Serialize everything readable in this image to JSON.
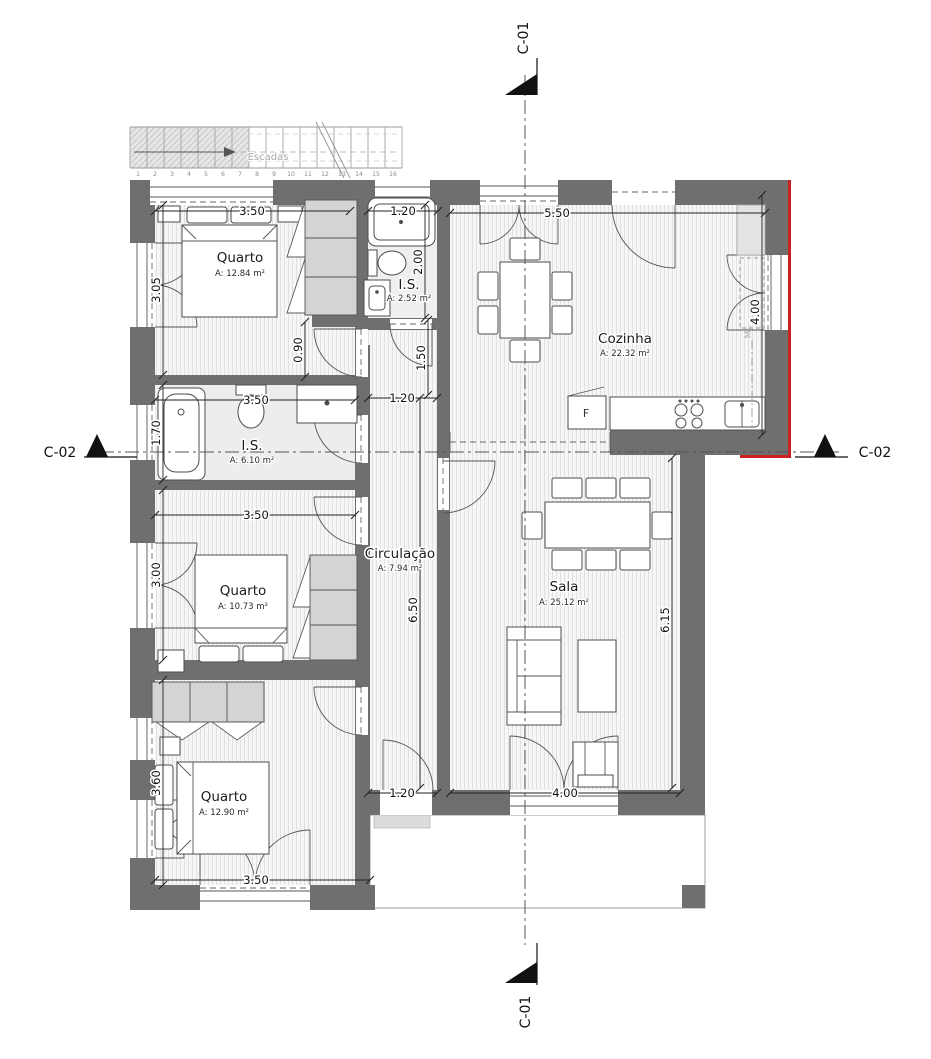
{
  "section_markers": {
    "c01_top": "C-01",
    "c01_bottom": "C-01",
    "c02_left": "C-02",
    "c02_right": "C-02"
  },
  "stairs": {
    "label": "Escadas",
    "steps": [
      "1",
      "2",
      "3",
      "4",
      "5",
      "6",
      "7",
      "8",
      "9",
      "10",
      "11",
      "12",
      "13",
      "14",
      "15",
      "16"
    ]
  },
  "rooms": [
    {
      "name": "Quarto",
      "area": "A: 12.84 m²"
    },
    {
      "name": "I.S.",
      "area": "A: 2.52 m²"
    },
    {
      "name": "Cozinha",
      "area": "A: 22.32 m²"
    },
    {
      "name": "I.S.",
      "area": "A: 6.10 m²"
    },
    {
      "name": "Quarto",
      "area": "A: 10.73 m²"
    },
    {
      "name": "Circulação",
      "area": "A: 7.94 m²"
    },
    {
      "name": "Sala",
      "area": "A: 25.12 m²"
    },
    {
      "name": "Quarto",
      "area": "A: 12.90 m²"
    }
  ],
  "appliances": {
    "fridge": "F",
    "washing_machine": "ML"
  },
  "dim": {
    "bed1_w": "3.50",
    "is2_w": "1.20",
    "kitchen_w": "5.50",
    "bed1_h": "3.05",
    "is2_h": "2.00",
    "nook": "0.90",
    "vest_h": "1.50",
    "is1_w": "3.50",
    "is1_h": "1.70",
    "vest_w": "1.20",
    "bed2_w": "3.50",
    "bed2_h": "3.00",
    "hall_l": "6.50",
    "kitchen_h": "4.00",
    "sala_h": "6.15",
    "bed3_h": "3.60",
    "hall_exit_w": "1.20",
    "sala_door_w": "4.00",
    "bed3_w": "3.50"
  },
  "colors": {
    "wall": "#6f6f6f",
    "accent": "#cc1f1f"
  }
}
